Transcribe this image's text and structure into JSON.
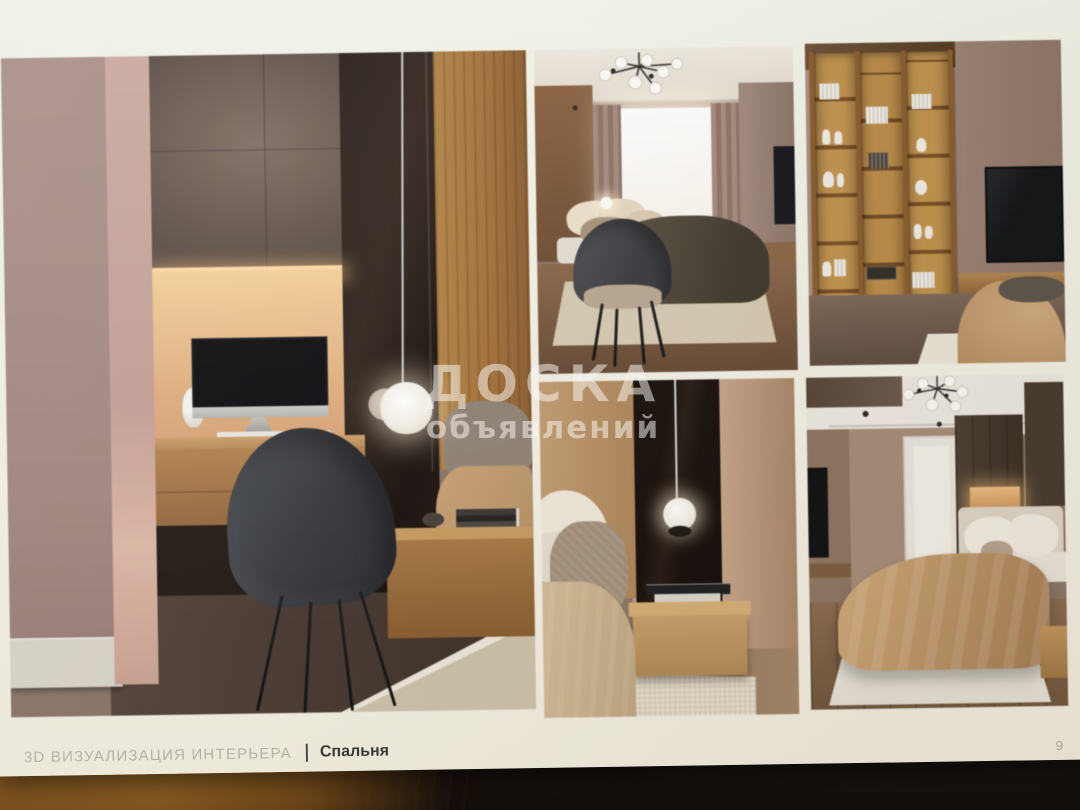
{
  "footer": {
    "label": "3D ВИЗУАЛИЗАЦИЯ ИНТЕРЬЕРА",
    "divider": "|",
    "room": "Спальня"
  },
  "page_number": "9",
  "watermark": {
    "line1": "ДОСКА",
    "line2": "объявлений"
  },
  "images": [
    {
      "id": "office-nook",
      "subject": "Desk niche with iMac, glowing pendant lamp and dark armchair"
    },
    {
      "id": "bedroom-window",
      "subject": "Bedroom with bed, dark armchair and bright window"
    },
    {
      "id": "shelving-tv",
      "subject": "Tall wooden open shelving with decor and wall-mounted TV"
    },
    {
      "id": "bedside-detail",
      "subject": "Bedside pendant light over oak nightstand with books"
    },
    {
      "id": "bedroom-door",
      "subject": "Bedroom with white door, chandelier and camel bedspread"
    }
  ],
  "colors": {
    "page_bg": "#efece1",
    "wall_mauve": "#a98c86",
    "accent_wood": "#b5813f",
    "blanket_camel": "#c49a66",
    "footer_muted": "#b4b0a5",
    "footer_dark": "#3b3a36"
  }
}
